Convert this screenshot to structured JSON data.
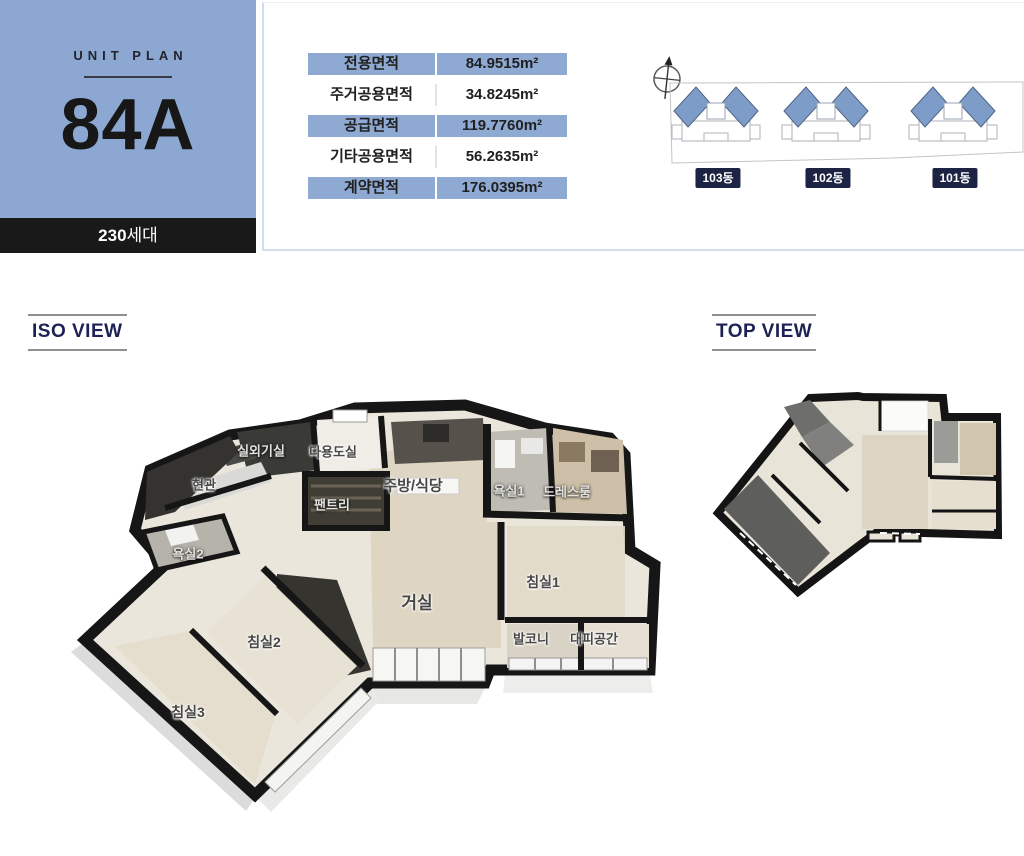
{
  "unit_card": {
    "eyebrow": "UNIT PLAN",
    "code": "84A",
    "households_count": "230",
    "households_suffix": "세대"
  },
  "area_table": {
    "unit": "m²",
    "rows": [
      {
        "label": "전용면적",
        "value": "84.9515"
      },
      {
        "label": "주거공용면적",
        "value": "34.8245"
      },
      {
        "label": "공급면적",
        "value": "119.7760"
      },
      {
        "label": "기타공용면적",
        "value": "56.2635"
      },
      {
        "label": "계약면적",
        "value": "176.0395"
      }
    ]
  },
  "site_plan": {
    "buildings": [
      {
        "label": "103동",
        "x": 71
      },
      {
        "label": "102동",
        "x": 181
      },
      {
        "label": "101동",
        "x": 308
      }
    ]
  },
  "iso_section": {
    "title": "ISO VIEW",
    "room_labels": [
      {
        "name": "실외기실",
        "x": 236,
        "y": 70,
        "size": 13,
        "light": true
      },
      {
        "name": "다용도실",
        "x": 308,
        "y": 71,
        "size": 13,
        "light": false
      },
      {
        "name": "현관",
        "x": 179,
        "y": 104,
        "size": 13,
        "light": false
      },
      {
        "name": "팬트리",
        "x": 307,
        "y": 124,
        "size": 13,
        "light": true
      },
      {
        "name": "주방/식당",
        "x": 388,
        "y": 105,
        "size": 15,
        "light": false
      },
      {
        "name": "욕실1",
        "x": 484,
        "y": 110,
        "size": 13,
        "light": true
      },
      {
        "name": "드레스룸",
        "x": 542,
        "y": 111,
        "size": 13,
        "light": true
      },
      {
        "name": "욕실2",
        "x": 163,
        "y": 173,
        "size": 13,
        "light": true
      },
      {
        "name": "거실",
        "x": 392,
        "y": 221,
        "size": 17,
        "light": false
      },
      {
        "name": "침실1",
        "x": 518,
        "y": 202,
        "size": 14,
        "light": false
      },
      {
        "name": "발코니",
        "x": 506,
        "y": 258,
        "size": 13,
        "light": false
      },
      {
        "name": "대피공간",
        "x": 569,
        "y": 258,
        "size": 13,
        "light": false
      },
      {
        "name": "침실2",
        "x": 239,
        "y": 262,
        "size": 14,
        "light": false
      },
      {
        "name": "침실3",
        "x": 163,
        "y": 332,
        "size": 14,
        "light": false
      }
    ]
  },
  "top_section": {
    "title": "TOP VIEW"
  },
  "colors": {
    "card_blue": "#8CA8D2",
    "row_blue": "#8EAAD3",
    "bar_black": "#191919",
    "panel_border": "#D3DEEC",
    "title_navy": "#1E2155",
    "building_label_navy": "#1D2443",
    "building_blue": "#7E9CC8"
  }
}
